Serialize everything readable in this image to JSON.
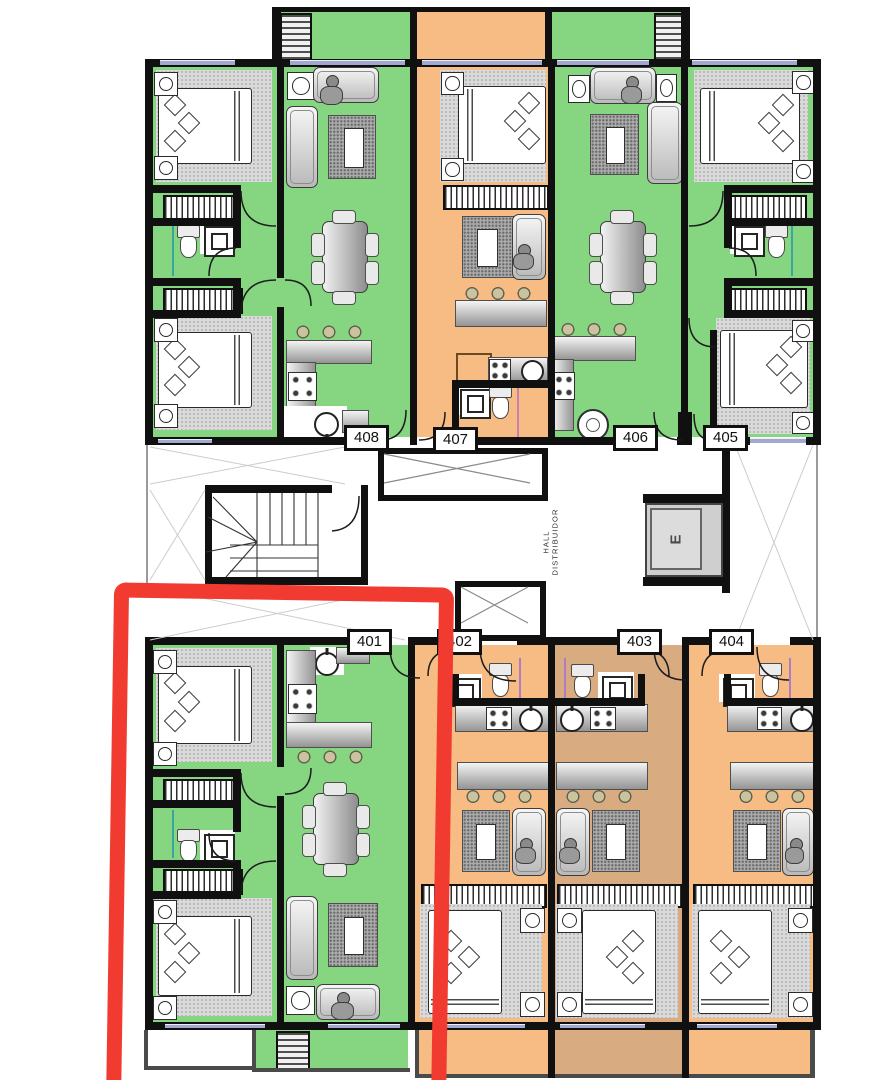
{
  "floor_plan": {
    "units": [
      {
        "label": "408"
      },
      {
        "label": "407"
      },
      {
        "label": "406"
      },
      {
        "label": "405"
      },
      {
        "label": "401"
      },
      {
        "label": "402"
      },
      {
        "label": "403"
      },
      {
        "label": "404"
      }
    ],
    "hall_text_line1": "HALL",
    "hall_text_line2": "DISTRIBUIDOR",
    "elevator_label": "E",
    "highlighted_unit": "401",
    "colors": {
      "apartment_green": "#85D581",
      "apartment_orange": "#F7BC84",
      "apartment_tan": "#D8AC80",
      "highlight_red": "#F23B30",
      "wall_black": "#101010",
      "window_blue": "#A2A8D0"
    }
  }
}
